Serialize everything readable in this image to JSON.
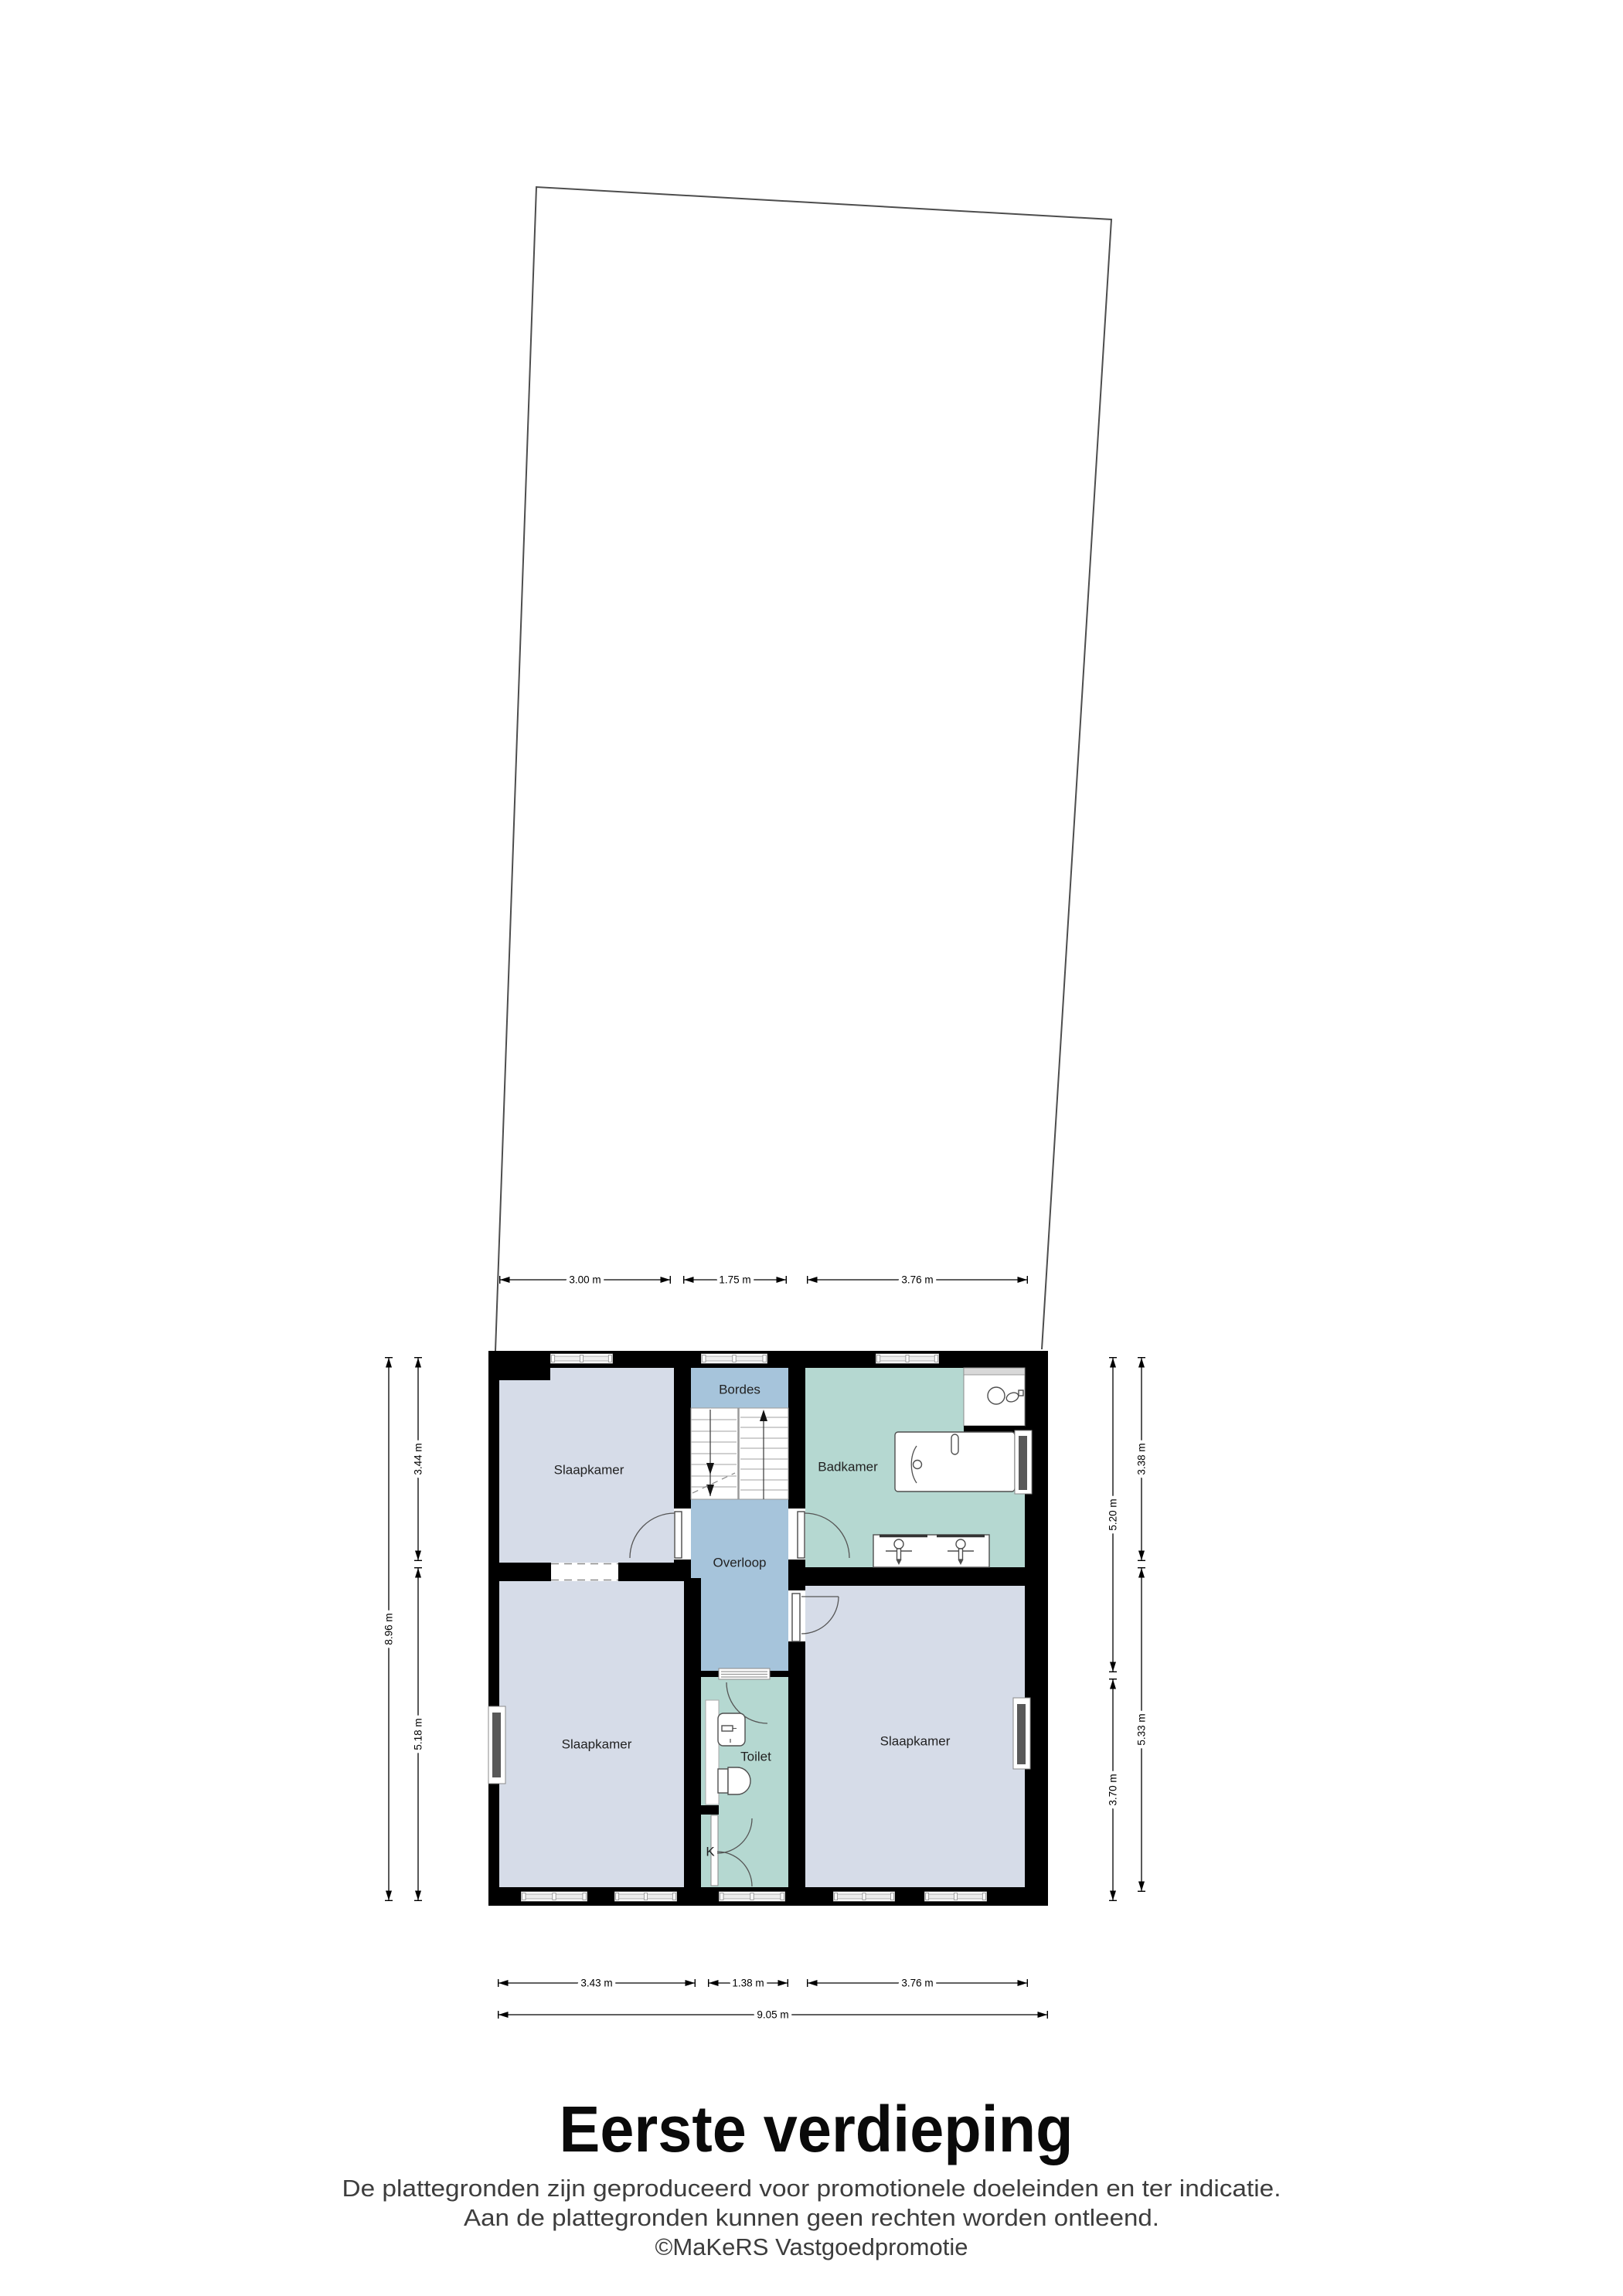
{
  "floorplan": {
    "rooms": {
      "slaapkamer_tl": "Slaapkamer",
      "slaapkamer_bl": "Slaapkamer",
      "slaapkamer_br": "Slaapkamer",
      "badkamer": "Badkamer",
      "bordes": "Bordes",
      "overloop": "Overloop",
      "toilet": "Toilet",
      "kast": "K"
    },
    "dimensions": {
      "top": {
        "d1": "3.00 m",
        "d2": "1.75 m",
        "d3": "3.76 m"
      },
      "bottom": {
        "d1": "3.43 m",
        "d2": "1.38 m",
        "d3": "3.76 m",
        "total": "9.05 m"
      },
      "left": {
        "outer": "8.96 m",
        "top": "3.44 m",
        "bottom": "5.18 m"
      },
      "right": {
        "inner_top": "5.20 m",
        "inner_bottom": "3.70 m",
        "outer_top": "3.38 m",
        "outer_bottom": "5.33 m"
      }
    },
    "colors": {
      "bedroom": "#d6dce8",
      "hall": "#a6c4db",
      "bathroom": "#b5d8d1",
      "wall": "#000000",
      "window_glass": "#595959"
    },
    "footer": {
      "title": "Eerste verdieping",
      "disclaimer_line1": "De plattegronden zijn geproduceerd voor promotionele doeleinden en ter indicatie.",
      "disclaimer_line2": "Aan de plattegronden kunnen geen rechten worden ontleend.",
      "copyright": "©MaKeRS Vastgoedpromotie"
    }
  }
}
